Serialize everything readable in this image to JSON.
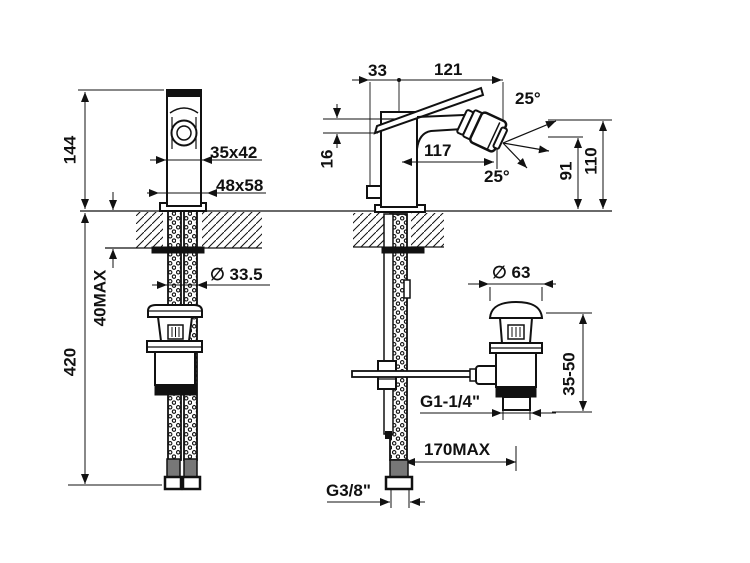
{
  "meta": {
    "line_color": "#111111",
    "background_color": "#ffffff"
  },
  "dims": {
    "front_height": "144",
    "front_body_section": "35x42",
    "front_base_section": "48x58",
    "front_deck_thickness": "40MAX",
    "front_hose_length": "420",
    "front_shank_diameter": "∅ 33.5",
    "side_handle_back": "33",
    "side_handle_reach": "121",
    "side_spray_angle_up": "25°",
    "side_spray_angle_down": "25°",
    "side_spout_reach": "117",
    "side_spout_lip": "16",
    "side_outlet_height": "91",
    "side_total_height": "110",
    "waste_cap_diameter": "∅ 63",
    "waste_clamp_range": "35-50",
    "waste_thread": "G1-1/4\"",
    "waste_linkage_reach": "170MAX",
    "hose_thread": "G3/8\""
  }
}
